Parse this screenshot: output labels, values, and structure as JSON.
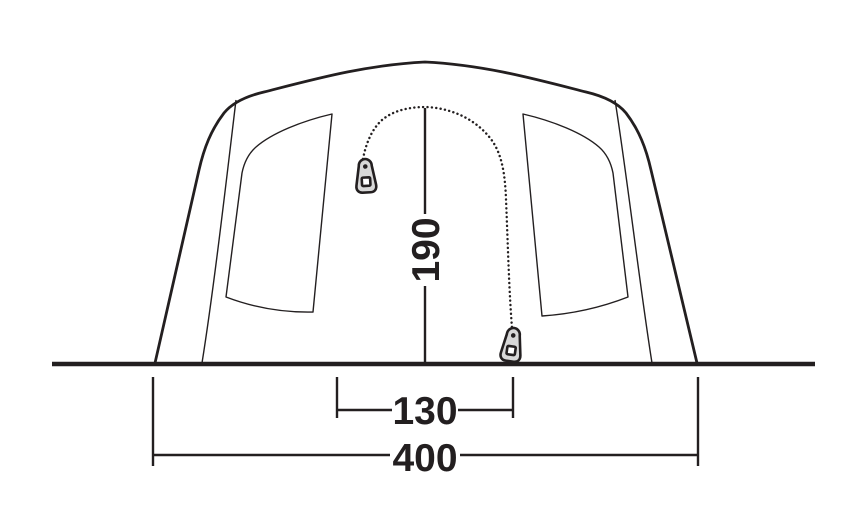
{
  "dimensions": {
    "height_label": "190",
    "door_width_label": "130",
    "total_width_label": "400"
  },
  "colors": {
    "line": "#231f20",
    "zipper_pull_fill": "#d8d8d8",
    "hole_fill": "#ffffff",
    "background": "#ffffff"
  },
  "icons": {
    "zipper_pull_top": "zipper-pull-icon",
    "zipper_pull_bottom": "zipper-pull-icon"
  }
}
